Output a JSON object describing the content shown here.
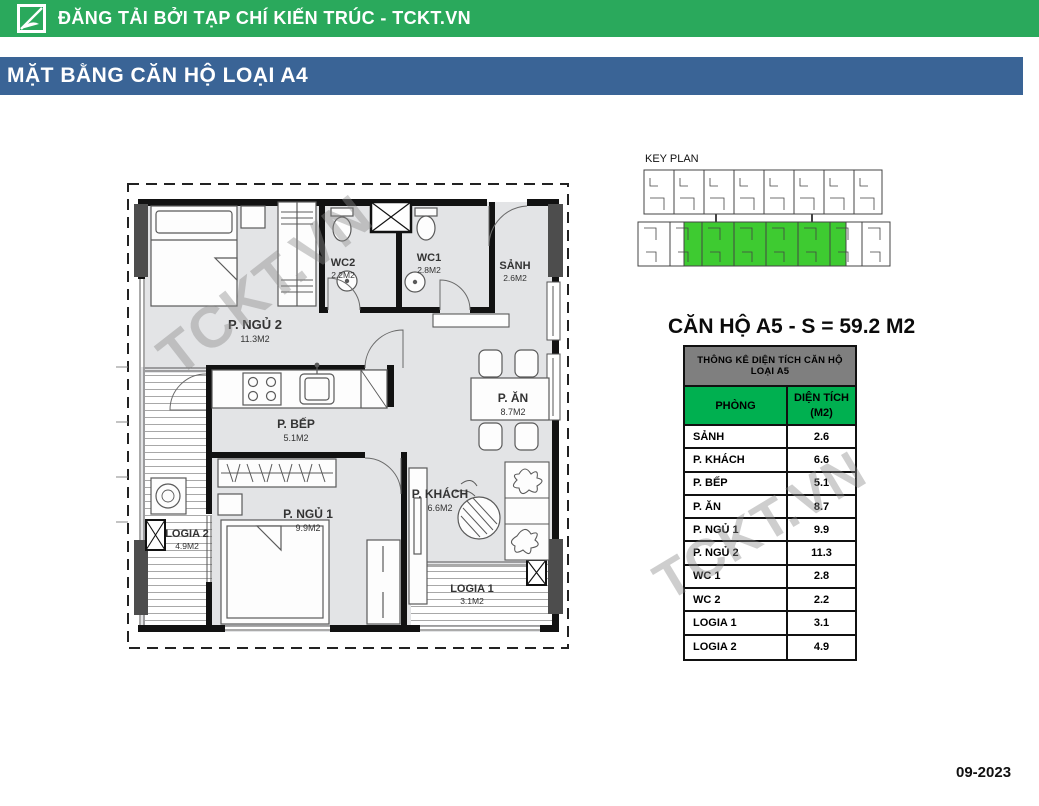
{
  "header": {
    "logo": "tckt-logo",
    "text": "ĐĂNG TẢI BỞI TẠP CHÍ KIẾN TRÚC - TCKT.VN"
  },
  "title_bar": {
    "text": "MẶT BẰNG CĂN HỘ LOẠI A4"
  },
  "key_plan": {
    "label": "KEY PLAN",
    "highlight_color": "#3ecb31"
  },
  "apartment_title": "CĂN HỘ A5 - S = 59.2 M2",
  "area_table": {
    "title": "THÔNG KÊ DIỆN TÍCH CĂN HỘ LOẠI A5",
    "col_room": "PHÒNG",
    "col_area_line1": "DIỆN TÍCH",
    "col_area_line2": "(M2)",
    "rows": [
      {
        "room": "SẢNH",
        "area": "2.6"
      },
      {
        "room": "P. KHÁCH",
        "area": "6.6"
      },
      {
        "room": "P. BẾP",
        "area": "5.1"
      },
      {
        "room": "P. ĂN",
        "area": "8.7"
      },
      {
        "room": "P. NGỦ 1",
        "area": "9.9"
      },
      {
        "room": "P. NGỦ 2",
        "area": "11.3"
      },
      {
        "room": "WC 1",
        "area": "2.8"
      },
      {
        "room": "WC 2",
        "area": "2.2"
      },
      {
        "room": "LOGIA 1",
        "area": "3.1"
      },
      {
        "room": "LOGIA 2",
        "area": "4.9"
      }
    ]
  },
  "floor_plan": {
    "rooms": [
      {
        "name": "P. NGỦ 2",
        "area": "11.3M2"
      },
      {
        "name": "WC2",
        "area": "2.2M2"
      },
      {
        "name": "WC1",
        "area": "2.8M2"
      },
      {
        "name": "SẢNH",
        "area": "2.6M2"
      },
      {
        "name": "P. BẾP",
        "area": "5.1M2"
      },
      {
        "name": "P. ĂN",
        "area": "8.7M2"
      },
      {
        "name": "P. NGỦ 1",
        "area": "9.9M2"
      },
      {
        "name": "P. KHÁCH",
        "area": "6.6M2"
      },
      {
        "name": "LOGIA 2",
        "area": "4.9M2"
      },
      {
        "name": "LOGIA 1",
        "area": "3.1M2"
      }
    ]
  },
  "watermark": {
    "text": "TCKT.VN"
  },
  "footer": {
    "date": "09-2023"
  },
  "colors": {
    "header_green": "#2aa95c",
    "title_blue": "#3a6496",
    "table_header_gray": "#7f7f7f",
    "table_green": "#00b050"
  }
}
